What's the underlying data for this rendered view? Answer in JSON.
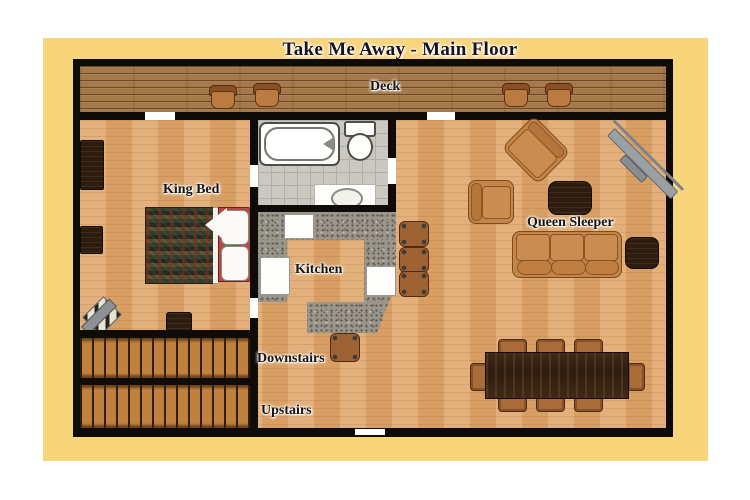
{
  "title": "Take Me Away - Main Floor",
  "rooms": {
    "deck": {
      "label": "Deck",
      "furniture": [
        "deck chair",
        "deck chair",
        "deck chair",
        "deck chair"
      ]
    },
    "bedroom": {
      "label": "King Bed",
      "furniture": [
        "dresser",
        "nightstand",
        "king bed with lodge quilt and red headboard",
        "blanket chest",
        "corner chair with triangle blanket"
      ]
    },
    "bathroom": {
      "furniture": [
        "bathtub",
        "toilet",
        "sink vanity"
      ]
    },
    "kitchen": {
      "label": "Kitchen",
      "furniture": [
        "u-shaped granite counter",
        "range",
        "refrigerator",
        "dishwasher",
        "bar stool",
        "bar stool",
        "bar stool",
        "bar stool"
      ]
    },
    "living": {
      "label": "Queen Sleeper",
      "furniture": [
        "corner tv",
        "angled armchair",
        "armchair",
        "dark coffee table",
        "queen sleeper sofa",
        "dark end table"
      ]
    },
    "dining": {
      "furniture": [
        "dark dining table",
        "dining chair",
        "dining chair",
        "dining chair",
        "dining chair",
        "dining chair",
        "dining chair",
        "dining chair",
        "dining chair"
      ]
    },
    "stairs": {
      "label_down": "Downstairs",
      "label_up": "Upstairs"
    }
  },
  "colors": {
    "page_bg": "#ffffff",
    "mat_yellow": "#f8d47a",
    "wall_black": "#0e0b08",
    "floor_wood": "#e0a76c",
    "deck_wood": "#a5794a",
    "stair_wood": "#c0803f",
    "granite_gray": "#9a968c",
    "tile_gray": "#cbc8c1",
    "furniture_brown": "#c4854a",
    "dark_wood": "#2e1c0f",
    "bed_red": "#b34a45",
    "label_text": "#181410"
  }
}
